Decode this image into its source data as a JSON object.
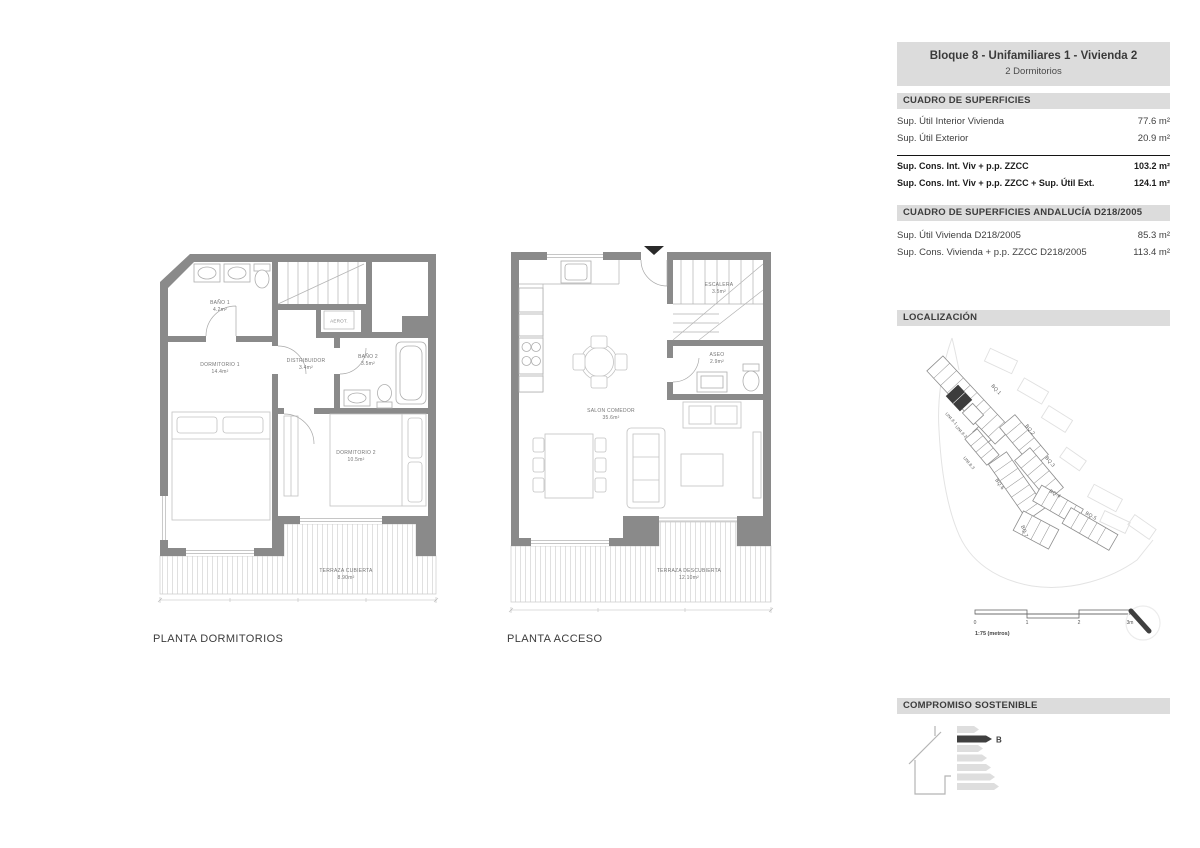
{
  "header": {
    "title": "Bloque 8 - Unifamiliares 1 - Vivienda 2",
    "subtitle": "2 Dormitorios"
  },
  "surfaces": {
    "title": "CUADRO DE SUPERFICIES",
    "rows": [
      {
        "label": "Sup. Útil Interior Vivienda",
        "value": "77.6 m²"
      },
      {
        "label": "Sup. Útil Exterior",
        "value": "20.9 m²"
      }
    ],
    "totals": [
      {
        "label": "Sup. Cons. Int. Viv + p.p. ZZCC",
        "value": "103.2 m²"
      },
      {
        "label": "Sup. Cons. Int. Viv + p.p. ZZCC + Sup. Útil Ext.",
        "value": "124.1 m²"
      }
    ]
  },
  "andalucia": {
    "title": "CUADRO DE SUPERFICIES ANDALUCÍA D218/2005",
    "rows": [
      {
        "label": "Sup. Útil Vivienda D218/2005",
        "value": "85.3 m²"
      },
      {
        "label": "Sup. Cons. Vivienda + p.p. ZZCC D218/2005",
        "value": "113.4 m²"
      }
    ]
  },
  "localizacion": {
    "title": "LOCALIZACIÓN",
    "blocks": {
      "bq1": "BQ.1",
      "bq2": "BQ.2",
      "bq3": "BQ.3",
      "bq4": "BQ.4",
      "bq5": "BQ.5",
      "bq6": "BQ.6",
      "bq7": "BQ.7",
      "uni81": "UNI.8.1",
      "uni82": "UNI.8.2",
      "uni83": "UNI.8.3"
    },
    "scale": {
      "t0": "0",
      "t1": "1",
      "t2": "2",
      "t3": "3m",
      "caption": "1:75 (metros)"
    }
  },
  "sustainability": {
    "title": "COMPROMISO SOSTENIBLE",
    "rating": "B"
  },
  "plans": {
    "dormitorios": {
      "title": "PLANTA DORMITORIOS",
      "rooms": {
        "bano1": {
          "name": "BAÑO 1",
          "area": "4.2m²"
        },
        "aerot": {
          "name": "AEROT."
        },
        "bano2": {
          "name": "BAÑO 2",
          "area": "3.5m²"
        },
        "distribuidor": {
          "name": "DISTRIBUIDOR",
          "area": "3.4m²"
        },
        "dormitorio1": {
          "name": "DORMITORIO 1",
          "area": "14.4m²"
        },
        "dormitorio2": {
          "name": "DORMITORIO 2",
          "area": "10.5m²"
        },
        "terraza": {
          "name": "TERRAZA CUBIERTA",
          "area": "8.90m²"
        }
      }
    },
    "acceso": {
      "title": "PLANTA ACCESO",
      "rooms": {
        "escalera": {
          "name": "ESCALERA",
          "area": "3.5m²"
        },
        "aseo": {
          "name": "ASEO",
          "area": "2.9m²"
        },
        "salon": {
          "name": "SALON COMEDOR",
          "area": "35.6m²"
        },
        "terraza": {
          "name": "TERRAZA DESCUBIERTA",
          "area": "12.10m²"
        }
      }
    }
  },
  "colors": {
    "wall": "#8a8a8a",
    "band": "#dcdcdc",
    "highlight": "#3d3d3d",
    "text": "#3f3f3f"
  }
}
